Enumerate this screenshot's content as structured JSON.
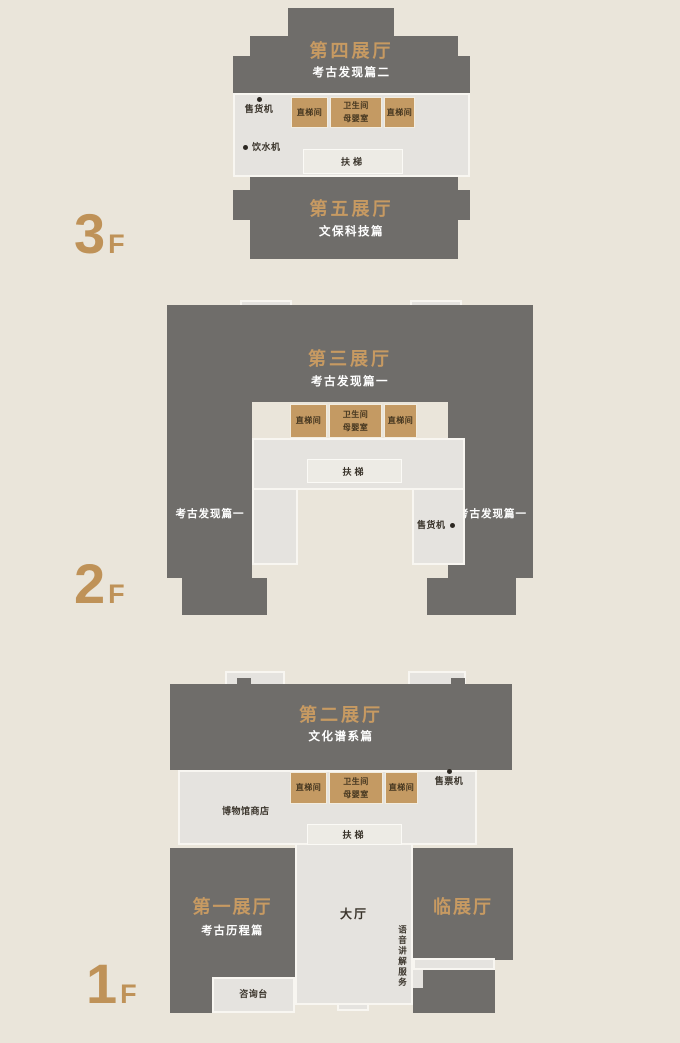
{
  "colors": {
    "background": "#eae5da",
    "hall_dark": "#6f6d6a",
    "corridor_light": "#e5e3df",
    "facility_tan": "#c49a63",
    "accent_gold": "#c79a62",
    "floor_label_gold": "#bf9258",
    "text_dark": "#3a342b",
    "text_white": "#ffffff"
  },
  "facilities": {
    "elevator": "直梯间",
    "restroom": "卫生间",
    "nursery": "母婴室",
    "escalator": "扶梯",
    "vending_machine": "售货机",
    "water_dispenser": "饮水机",
    "ticket_machine": "售票机"
  },
  "floor3": {
    "label": "3",
    "suffix": "F",
    "hall4": {
      "name": "第四展厅",
      "subtitle": "考古发现篇二"
    },
    "hall5": {
      "name": "第五展厅",
      "subtitle": "文保科技篇"
    }
  },
  "floor2": {
    "label": "2",
    "suffix": "F",
    "hall3": {
      "name": "第三展厅",
      "subtitle": "考古发现篇一"
    },
    "left_wing": "考古发现篇一",
    "right_wing": "考古发现篇一"
  },
  "floor1": {
    "label": "1",
    "suffix": "F",
    "hall2": {
      "name": "第二展厅",
      "subtitle": "文化谱系篇"
    },
    "hall1": {
      "name": "第一展厅",
      "subtitle": "考古历程篇"
    },
    "temporary_hall": "临展厅",
    "lobby": "大厅",
    "museum_shop": "博物馆商店",
    "information_desk": "咨询台",
    "audio_guide_service": "语音讲解服务"
  }
}
